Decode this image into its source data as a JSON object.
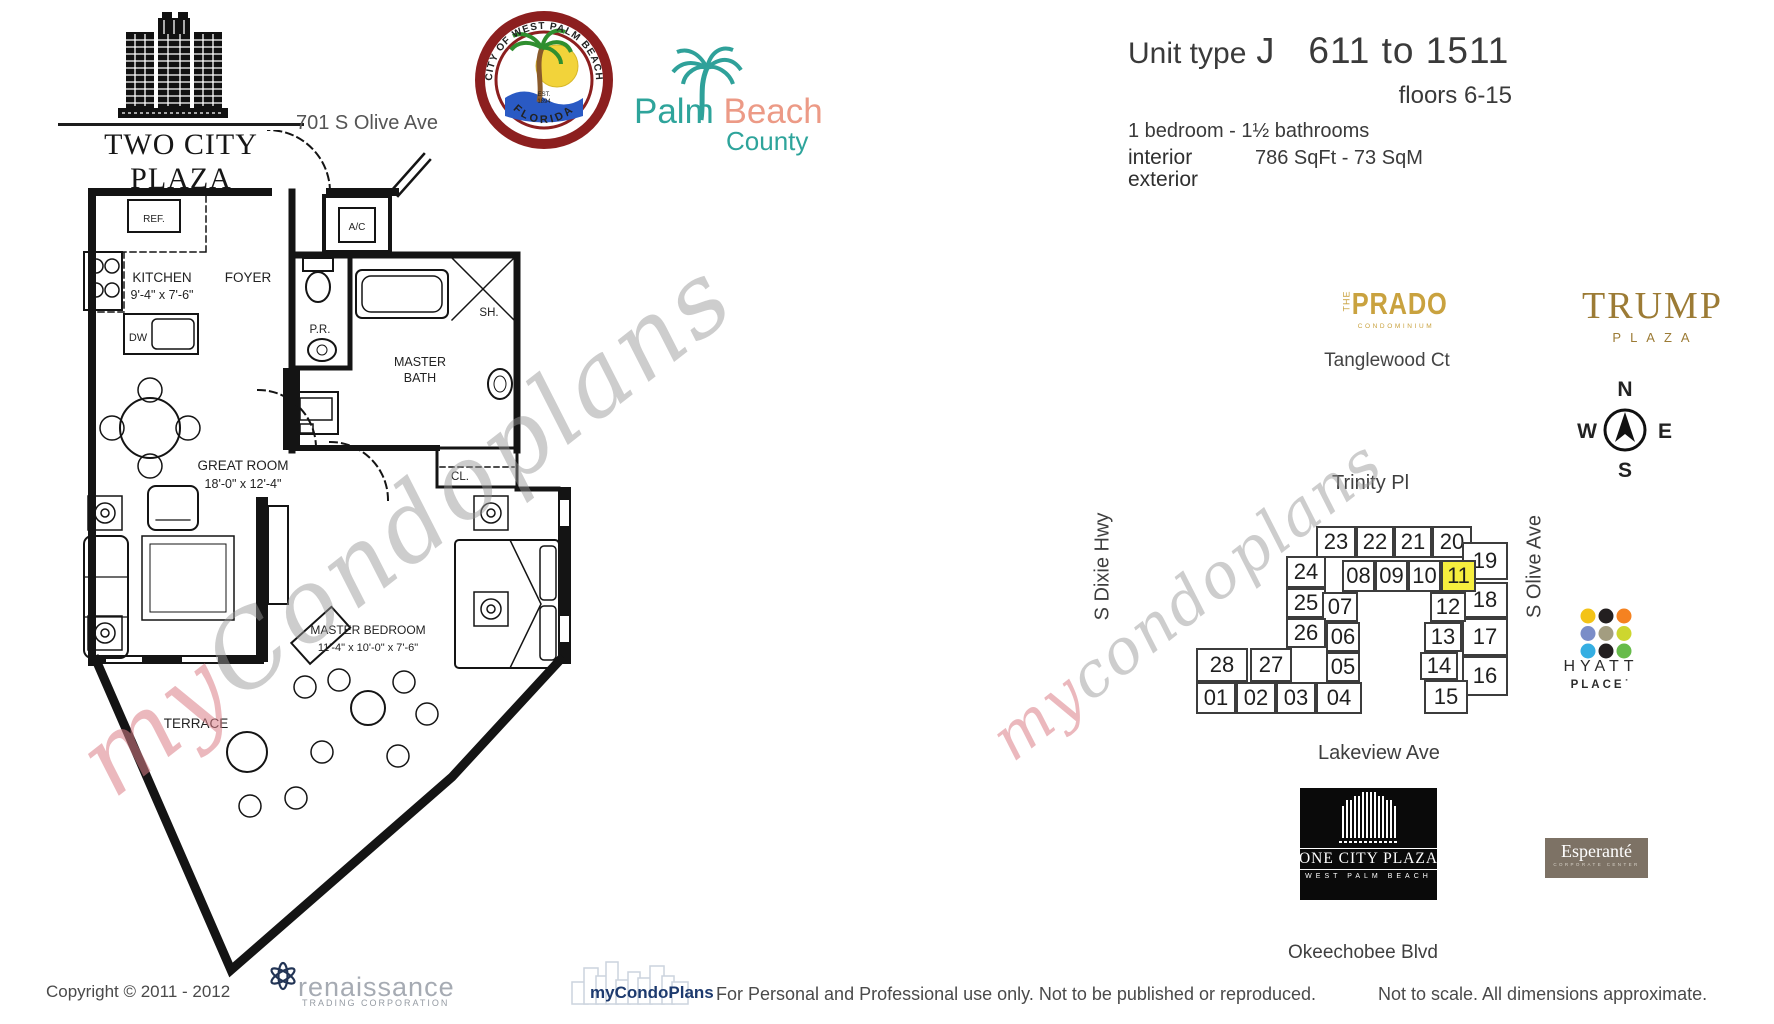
{
  "header": {
    "building_name": "TWO CITY PLAZA",
    "address": "701 S Olive Ave",
    "seal_top": "CITY OF WEST PALM BEACH",
    "seal_bottom": "FLORIDA",
    "seal_est1": "EST.",
    "seal_est2": "1894",
    "county_palm": "Palm ",
    "county_beach": "Beach",
    "county_word": "County",
    "unit_type_label": "Unit type",
    "unit_type": "J",
    "unit_range": "611 to 1511",
    "floors": "floors 6-15",
    "bed_bath": "1 bedroom - 1½ bathrooms",
    "interior_label": "interior",
    "interior_value": "786 SqFt - 73 SqM",
    "exterior_label": "exterior"
  },
  "floorplan": {
    "kitchen_name": "KITCHEN",
    "kitchen_dims": "9'-4\" x 7'-6\"",
    "foyer": "FOYER",
    "ref": "REF.",
    "dw": "DW",
    "ac": "A/C",
    "pr": "P.R.",
    "master_bath_line1": "MASTER",
    "master_bath_line2": "BATH",
    "sh": "SH.",
    "cl": "CL.",
    "great_room": "GREAT ROOM",
    "great_room_dims": "18'-0\" x 12'-4\"",
    "master_bedroom": "MASTER BEDROOM",
    "master_bedroom_dims": "11'-4\" x 10'-0\" x 7'-6\"",
    "terrace": "TERRACE",
    "watermark_my": "my",
    "watermark_rest": "Condoplans"
  },
  "map": {
    "highlighted_unit": "11",
    "highlight_color": "#f6ee3e",
    "watermark_my": "my",
    "watermark_rest": "condoplans",
    "streets": {
      "top": "Trinity Pl",
      "left": "S Dixie Hwy",
      "right": "S Olive Ave",
      "bottom": "Lakeview Ave",
      "far_bottom": "Okeechobee Blvd"
    },
    "units": [
      {
        "label": "23",
        "x": 236,
        "y": 66,
        "w": 40,
        "h": 32
      },
      {
        "label": "22",
        "x": 276,
        "y": 66,
        "w": 38,
        "h": 32
      },
      {
        "label": "21",
        "x": 314,
        "y": 66,
        "w": 38,
        "h": 32
      },
      {
        "label": "20",
        "x": 352,
        "y": 66,
        "w": 40,
        "h": 32
      },
      {
        "label": "19",
        "x": 382,
        "y": 82,
        "w": 46,
        "h": 38
      },
      {
        "label": "18",
        "x": 382,
        "y": 122,
        "w": 46,
        "h": 36
      },
      {
        "label": "17",
        "x": 382,
        "y": 158,
        "w": 46,
        "h": 38
      },
      {
        "label": "16",
        "x": 382,
        "y": 196,
        "w": 46,
        "h": 40
      },
      {
        "label": "24",
        "x": 206,
        "y": 96,
        "w": 40,
        "h": 32
      },
      {
        "label": "08",
        "x": 262,
        "y": 100,
        "w": 33,
        "h": 32
      },
      {
        "label": "09",
        "x": 295,
        "y": 100,
        "w": 33,
        "h": 32
      },
      {
        "label": "10",
        "x": 328,
        "y": 100,
        "w": 33,
        "h": 32
      },
      {
        "label": "11",
        "x": 361,
        "y": 100,
        "w": 35,
        "h": 32
      },
      {
        "label": "25",
        "x": 206,
        "y": 128,
        "w": 40,
        "h": 30
      },
      {
        "label": "07",
        "x": 242,
        "y": 132,
        "w": 36,
        "h": 30
      },
      {
        "label": "12",
        "x": 350,
        "y": 132,
        "w": 36,
        "h": 30
      },
      {
        "label": "26",
        "x": 206,
        "y": 158,
        "w": 40,
        "h": 30
      },
      {
        "label": "06",
        "x": 246,
        "y": 162,
        "w": 34,
        "h": 30
      },
      {
        "label": "13",
        "x": 344,
        "y": 162,
        "w": 38,
        "h": 30
      },
      {
        "label": "05",
        "x": 246,
        "y": 192,
        "w": 34,
        "h": 30
      },
      {
        "label": "14",
        "x": 340,
        "y": 192,
        "w": 38,
        "h": 28
      },
      {
        "label": "28",
        "x": 116,
        "y": 188,
        "w": 52,
        "h": 34
      },
      {
        "label": "27",
        "x": 170,
        "y": 188,
        "w": 42,
        "h": 34
      },
      {
        "label": "15",
        "x": 344,
        "y": 220,
        "w": 44,
        "h": 34
      },
      {
        "label": "01",
        "x": 116,
        "y": 222,
        "w": 40,
        "h": 32
      },
      {
        "label": "02",
        "x": 156,
        "y": 222,
        "w": 40,
        "h": 32
      },
      {
        "label": "03",
        "x": 196,
        "y": 222,
        "w": 40,
        "h": 32
      },
      {
        "label": "04",
        "x": 236,
        "y": 222,
        "w": 46,
        "h": 32
      }
    ]
  },
  "compass": {
    "n": "N",
    "s": "S",
    "e": "E",
    "w": "W"
  },
  "landmarks": {
    "prado": {
      "the": "THE",
      "name": "PRADO",
      "sub": "CONDOMINIUM",
      "street": "Tanglewood Ct"
    },
    "trump": {
      "name": "TRUMP",
      "sub": "PLAZA"
    },
    "hyatt": {
      "line1": "HYATT",
      "line2": "PLACE˙",
      "dots": [
        "#f3c317",
        "#231f20",
        "#f58220",
        "#7b8dc8",
        "#a39d80",
        "#cdd62f",
        "#35aee2",
        "#231f20",
        "#67bb4a"
      ]
    },
    "one_city_plaza": {
      "name": "ONE CITY PLAZA",
      "sub": "WEST PALM BEACH"
    },
    "esperante": {
      "name": "Esperanté",
      "sub": "CORPORATE CENTER"
    }
  },
  "footer": {
    "copyright": "Copyright © 2011 - 2012",
    "renaissance": "renaissance",
    "renaissance_sub": "TRADING CORPORATION",
    "mycondoplans": "myCondoPlans",
    "disclaimer": "For Personal and Professional use only.  Not to be published or reproduced.",
    "scale_note": "Not to scale.  All dimensions approximate."
  }
}
